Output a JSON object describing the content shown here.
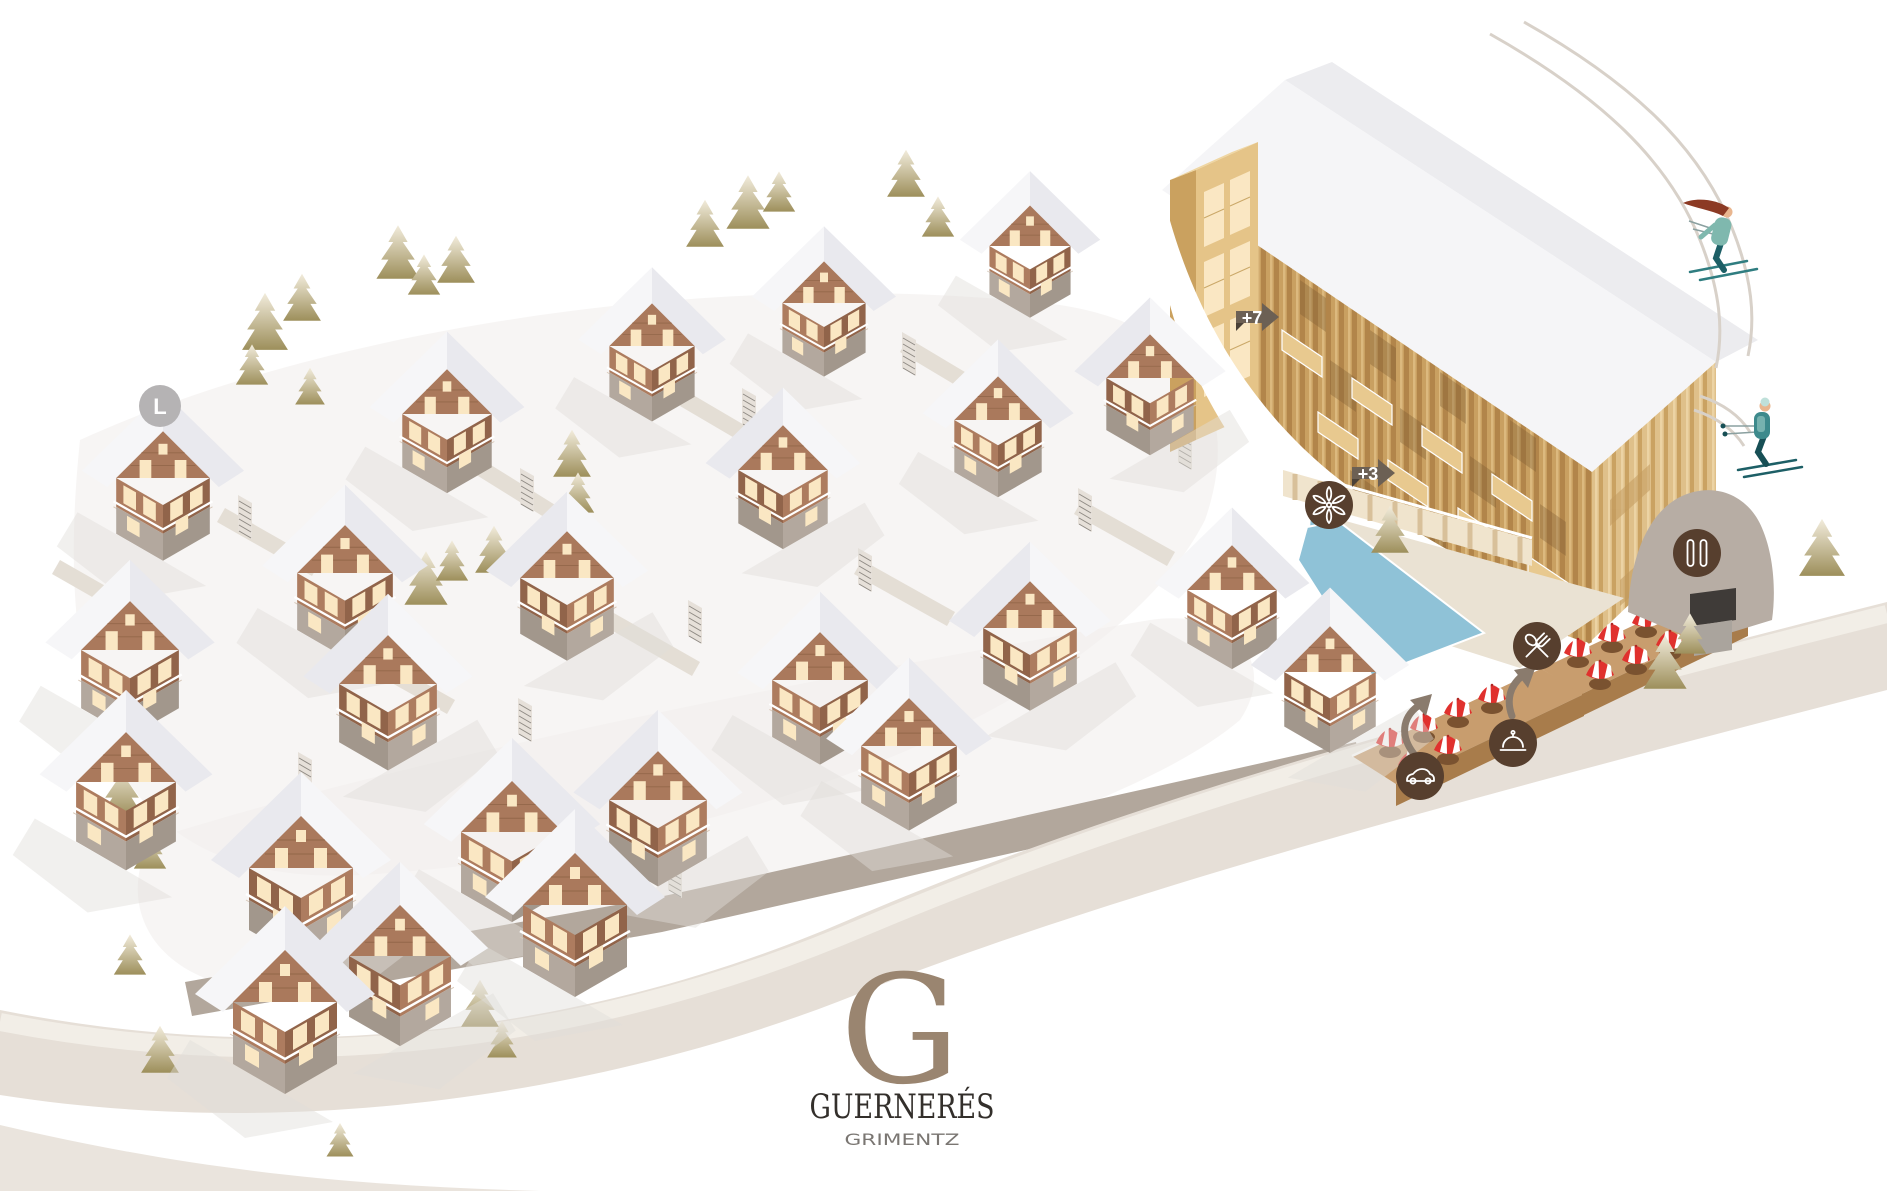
{
  "logo": {
    "monogram": "G",
    "name": "GUERNERÉS",
    "location": "GRIMENTZ"
  },
  "markers": {
    "lot": "L",
    "plus7": "+7",
    "plus3": "+3"
  },
  "amenities": {
    "spa": "flower-spa-icon",
    "restaurant": "fork-spoon-restaurant-icon",
    "valet": "car-valet-icon",
    "concierge": "service-bell-icon",
    "ski_room": "skis-icon"
  },
  "colors": {
    "background": "#ffffff",
    "road": "#e6dfd7",
    "snow_roof": "#f6f6f8",
    "chalet_wood": "#ad7c5f",
    "chalet_base": "#b3a89e",
    "window_cream": "#fae7c3",
    "hotel_wood": "#c9a061",
    "pool_blue": "#8fc2d7",
    "terrace_wood": "#c89d6e",
    "icon_circle": "#573f2e",
    "umbrella_red": "#e0312e",
    "badge_arrow": "#6c6054",
    "lot_badge": "#b5b3b4",
    "tree_dark": "#9d8f5b",
    "logo_monogram": "#9a8570",
    "logo_text": "#332f2b",
    "logo_subtext": "#7a7672",
    "skier_teal": "#2f7d80"
  }
}
